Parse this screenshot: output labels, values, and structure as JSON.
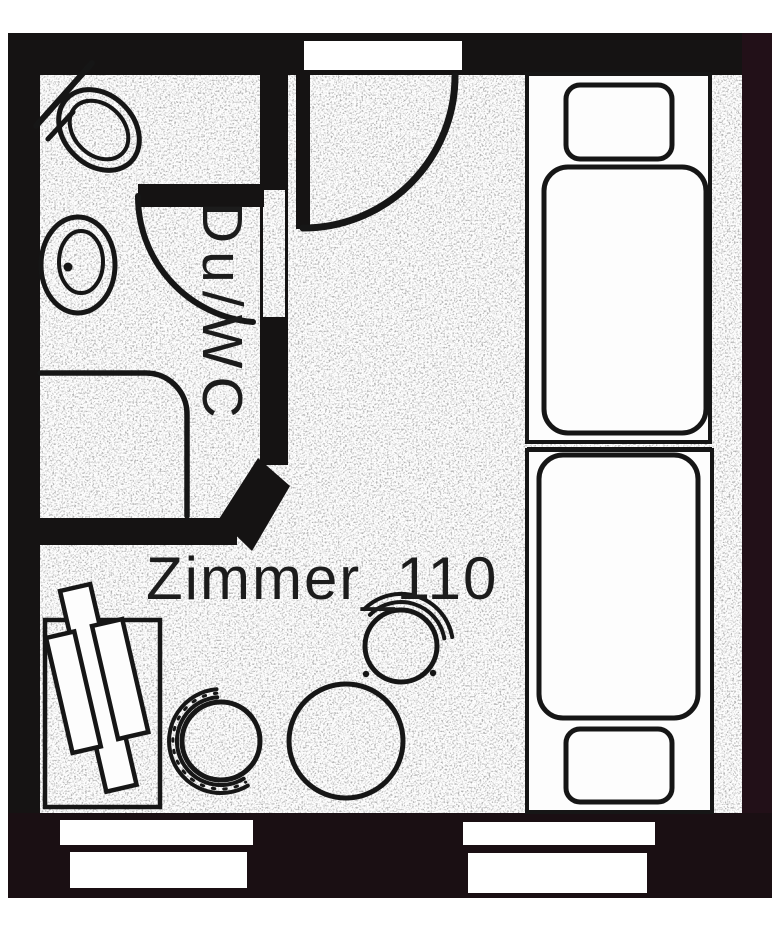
{
  "plan": {
    "room_label": "Zimmer_110",
    "bath_label": "Du/WC",
    "colors": {
      "wall": "#151313",
      "wall_right": "#221018",
      "wall_bottom": "#1a0f13",
      "line": "#161616",
      "floor": "#fdfdfd",
      "text": "#1c1c1c"
    }
  }
}
